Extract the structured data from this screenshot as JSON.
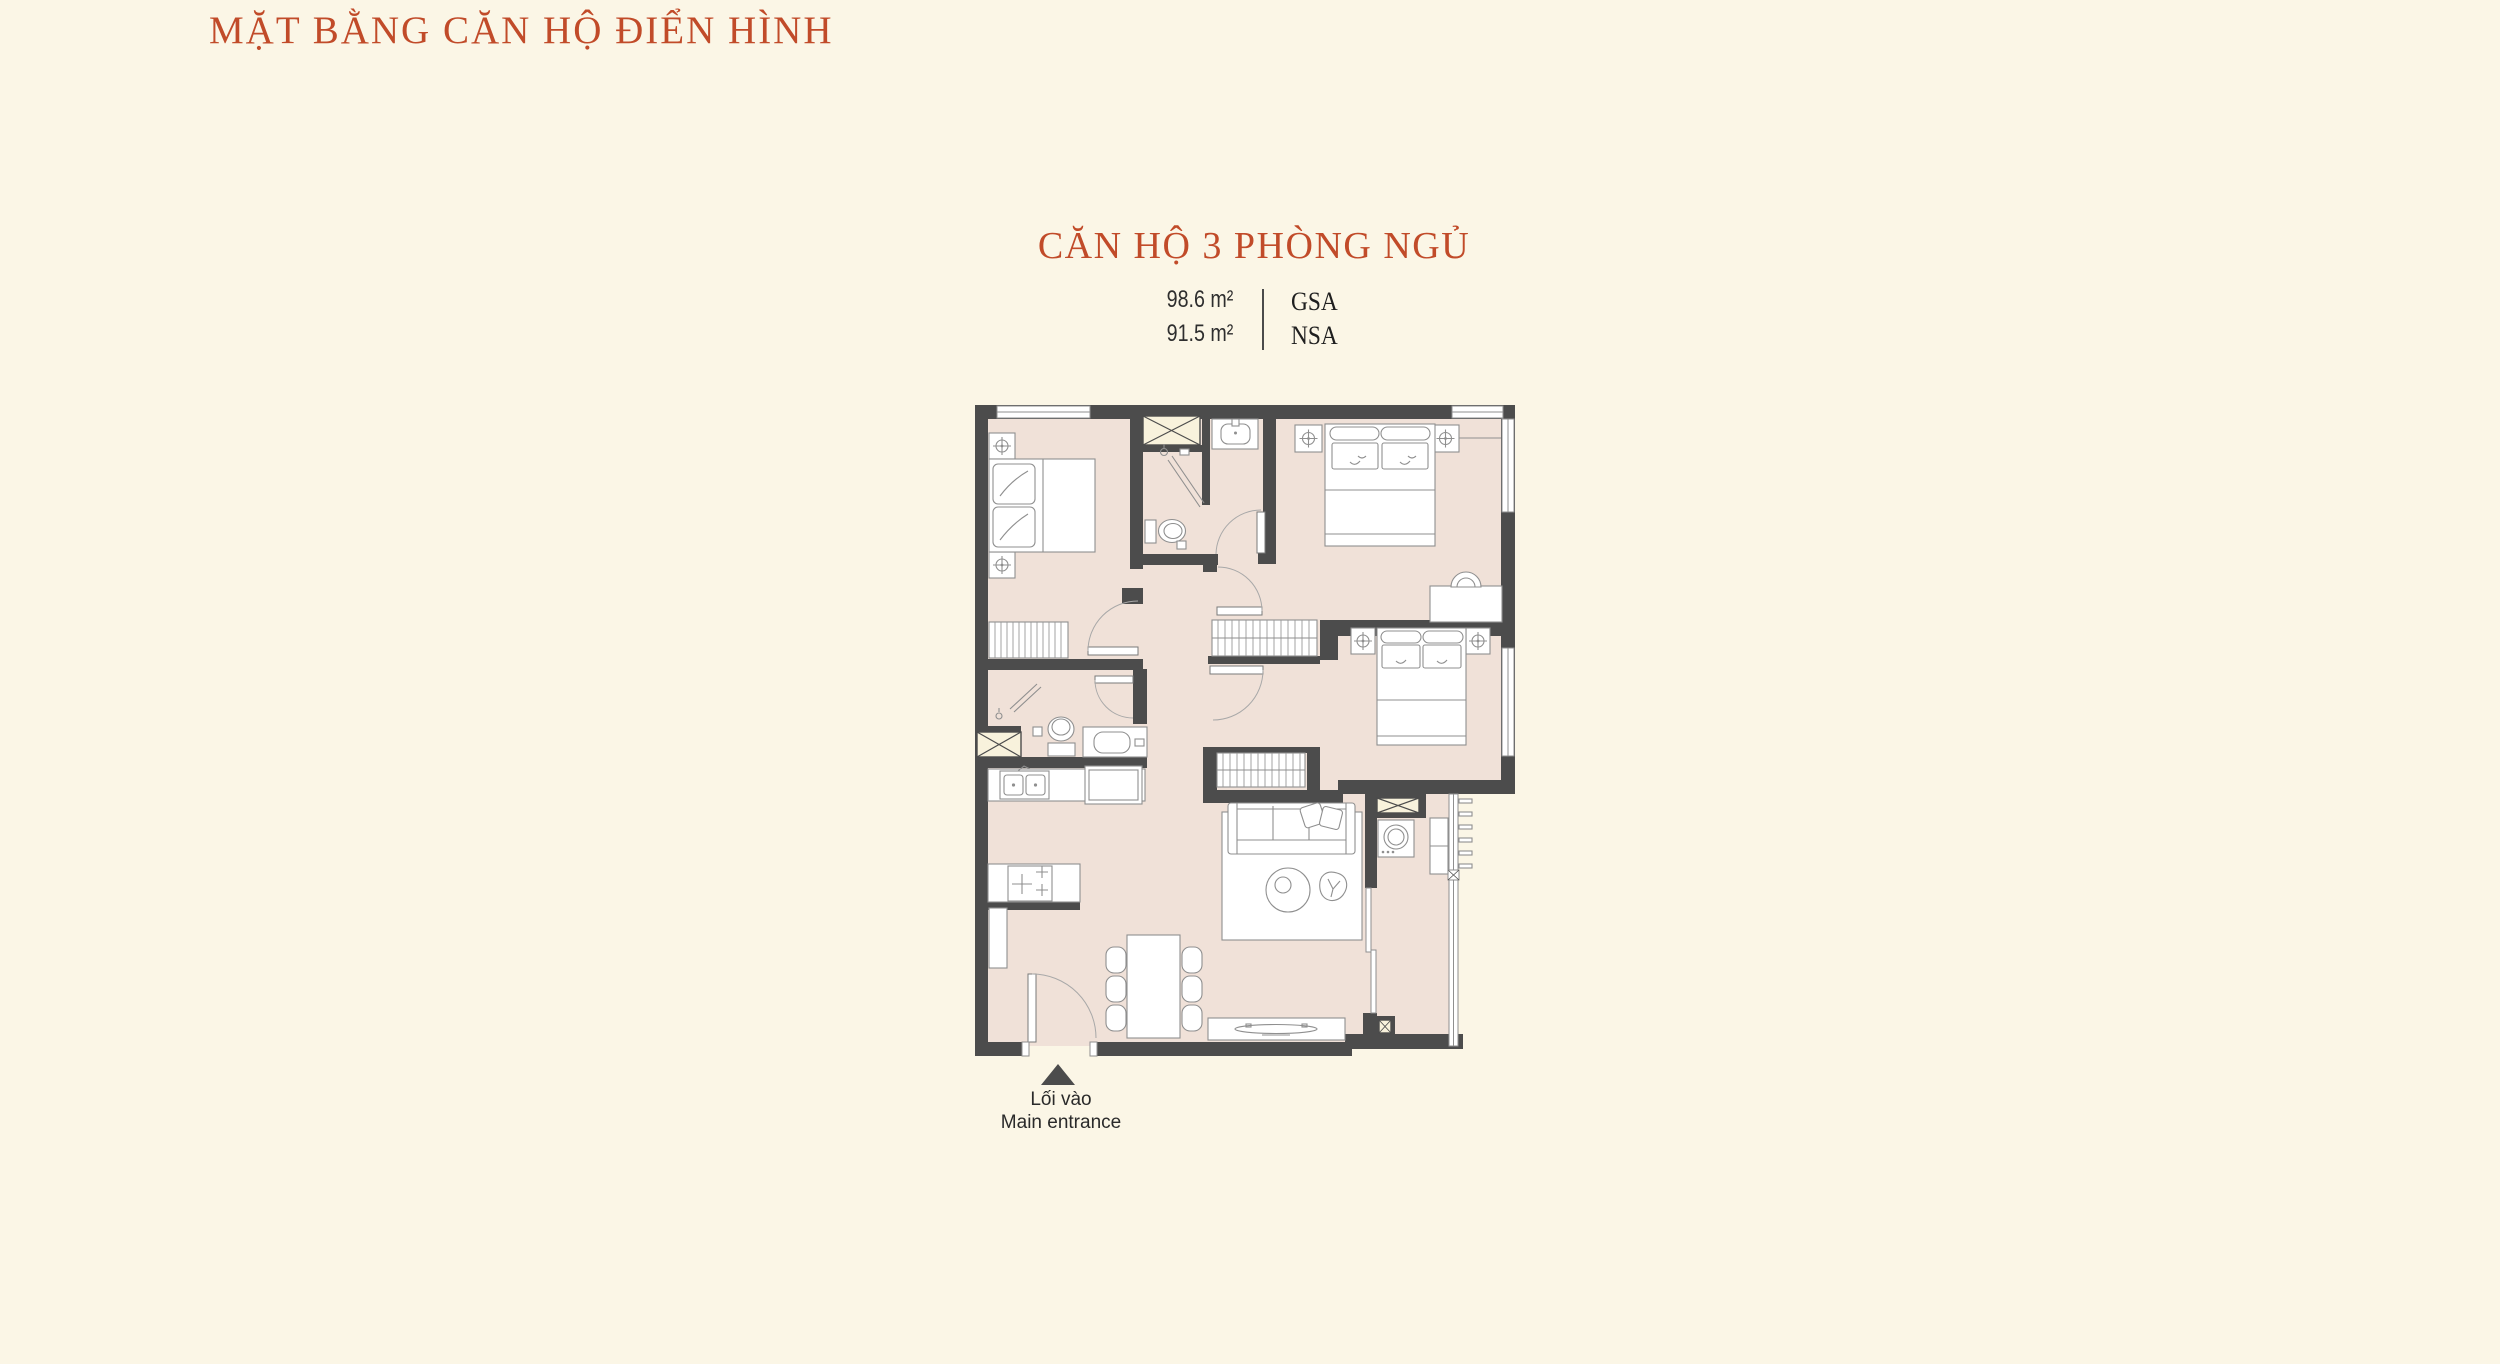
{
  "page": {
    "background": "#FBF6E6"
  },
  "header": {
    "title": "MẶT BẰNG CĂN HỘ ĐIỂN HÌNH"
  },
  "unit": {
    "title": "CĂN HỘ 3 PHÒNG NGỦ",
    "areas": [
      {
        "value": "98.6 m²",
        "label": "GSA"
      },
      {
        "value": "91.5 m²",
        "label": "NSA"
      }
    ]
  },
  "entrance": {
    "line1": "Lối vào",
    "line2": "Main entrance",
    "marker_icon": "entrance-arrow"
  },
  "floorplan": {
    "type": "apartment-floor-plan",
    "bedrooms": 3,
    "bathrooms": 2,
    "features": [
      "living-room",
      "kitchen",
      "dining-table",
      "balcony",
      "washer",
      "wardrobes"
    ]
  },
  "colors": {
    "background": "#FBF6E6",
    "accent": "#C14B29",
    "wall": "#4C4C4C",
    "floor": "#F0E1D8",
    "shaft": "#F8F2DC",
    "line": "#8F8F8F",
    "text": "#2E2E2E"
  }
}
